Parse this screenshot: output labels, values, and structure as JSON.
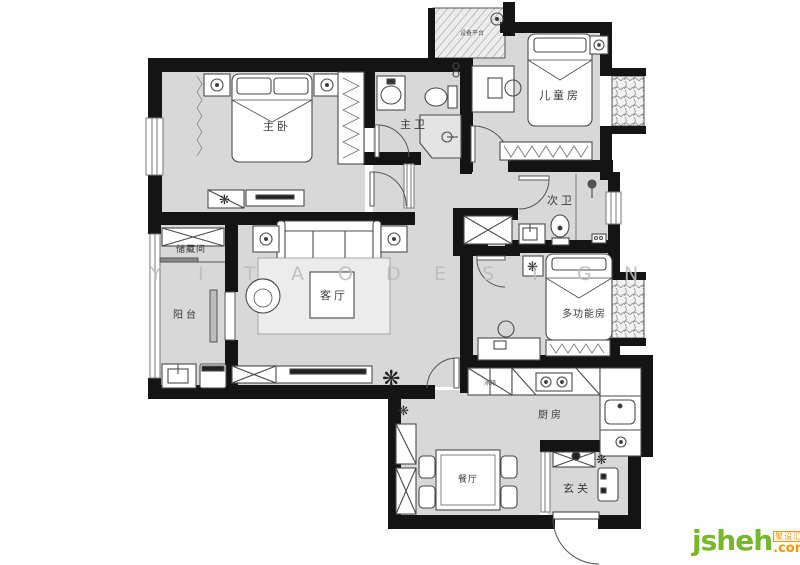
{
  "rooms": {
    "master_bedroom": "主卧",
    "master_bath": "主卫",
    "kids_room": "儿童房",
    "second_bath": "次卫",
    "multi_room": "多功能房",
    "living_room": "客厅",
    "storage": "储藏间",
    "balcony": "阳台",
    "kitchen": "厨房",
    "dining": "餐厅",
    "entry": "玄关"
  },
  "appliances": {
    "fridge": "冰箱",
    "equipment_platform": "设备平台"
  },
  "watermark_letters": [
    "Y",
    "I",
    "T",
    "A",
    "O",
    "D",
    "E",
    "S",
    "I",
    "G",
    "N"
  ],
  "logo": {
    "name": "jsheh",
    "badge": "聚设汇",
    "tld": ".com"
  },
  "icons": {
    "plant": "❋"
  },
  "colors": {
    "wall": "#141414",
    "room_fill": "#d8d8d8",
    "logo_green": "#76b82a",
    "logo_orange": "#f39800",
    "watermark": "#bcbcbc"
  }
}
